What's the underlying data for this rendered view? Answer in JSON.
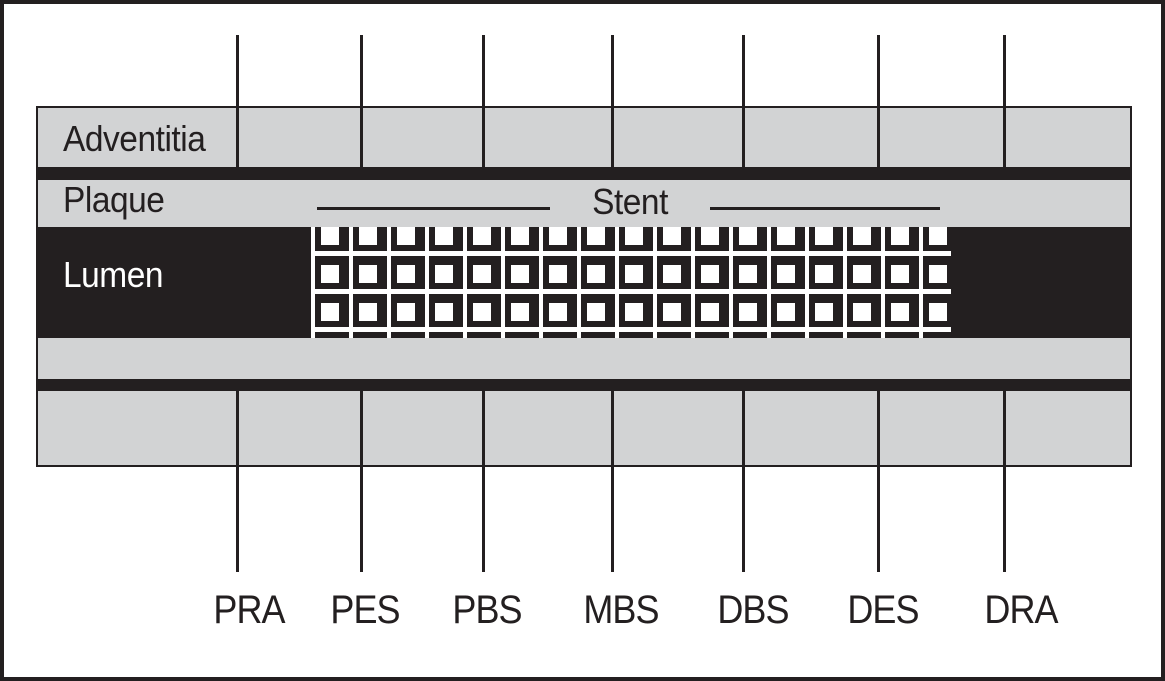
{
  "figure": {
    "title_hint": "Stented vessel longitudinal cross-section with analysis segments",
    "layers": {
      "adventitia": "Adventitia",
      "plaque": "Plaque",
      "lumen": "Lumen"
    },
    "stent": {
      "label": "Stent"
    },
    "segments": [
      {
        "label": "PRA",
        "line_x": 236,
        "label_cx": 249
      },
      {
        "label": "PES",
        "line_x": 360,
        "label_cx": 365
      },
      {
        "label": "PBS",
        "line_x": 482,
        "label_cx": 487
      },
      {
        "label": "MBS",
        "line_x": 611,
        "label_cx": 621
      },
      {
        "label": "DBS",
        "line_x": 742,
        "label_cx": 753
      },
      {
        "label": "DES",
        "line_x": 877,
        "label_cx": 883
      },
      {
        "label": "DRA",
        "line_x": 1003,
        "label_cx": 1021
      }
    ],
    "colors": {
      "ink": "#231f20",
      "gray": "#d2d3d4",
      "paper": "#ffffff"
    }
  }
}
